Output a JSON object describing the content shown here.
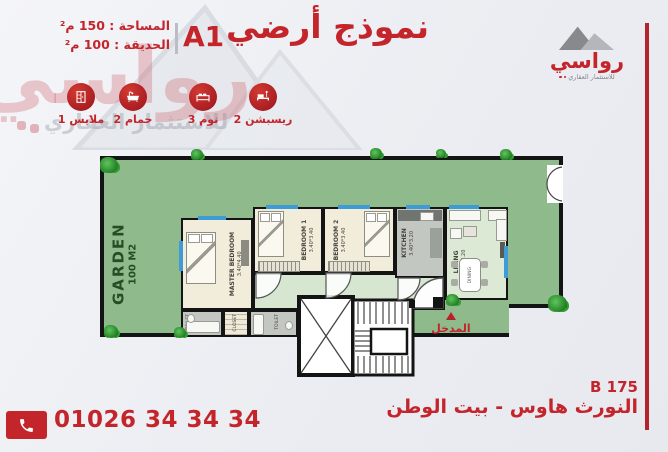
{
  "header": {
    "title": "نموذج أرضي",
    "model": "A1",
    "stats": [
      {
        "label": "المساحة : 150 م²"
      },
      {
        "label": "الحديقة : 100 م²"
      }
    ]
  },
  "brand": {
    "name": "رواسي",
    "tagline": "للاستثمار العقاري",
    "logo_icon": "mountains-logo-icon"
  },
  "features": [
    {
      "icon": "wardrobe-icon",
      "label": "1 ملابس"
    },
    {
      "icon": "bathtub-icon",
      "label": "2 حمام"
    },
    {
      "icon": "bed-icon",
      "label": "3 نوم"
    },
    {
      "icon": "sofa-icon",
      "label": "2 ريسبشن"
    }
  ],
  "plan": {
    "garden_label": "GARDEN",
    "garden_area": "100 M2",
    "dining_label": "DINING",
    "entrance_label": "المدخل",
    "rooms": [
      {
        "name": "MASTER BEDROOM",
        "dims": "3.40*4.40"
      },
      {
        "name": "BEDROOM 1",
        "dims": "3.40*3.40"
      },
      {
        "name": "BEDROOM 2",
        "dims": "3.40*3.40"
      },
      {
        "name": "KITCHEN",
        "dims": "3.40*3.20"
      },
      {
        "name": "LIVING",
        "dims": "5.10*3.20"
      },
      {
        "name": "TOILET",
        "dims": "1.40*2.40"
      },
      {
        "name": "CLOSET",
        "dims": "1.90*1.30"
      },
      {
        "name": "TOILET",
        "dims": "2.40*1.40"
      }
    ]
  },
  "footer": {
    "phone": "01026 34 34 34",
    "phone_icon": "phone-icon",
    "unit_code": "B 175",
    "project": "النورث هاوس - بيت الوطن"
  },
  "colors": {
    "brand_red": "#c3252b",
    "garden_green": "#8fba8c",
    "interior_cream": "#f2ecdb",
    "corridor_green": "#d7e6d0",
    "window_blue": "#3e9bd6",
    "wall_black": "#141414"
  }
}
